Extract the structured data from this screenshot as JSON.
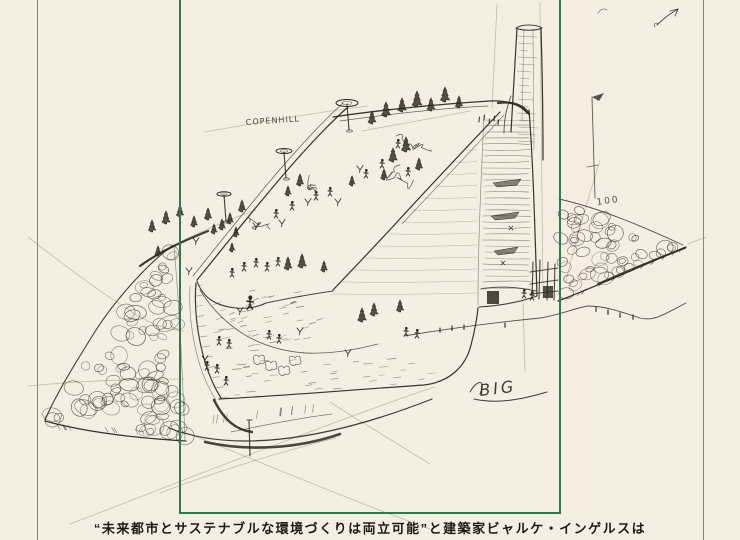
{
  "page": {
    "background": "#f4efe2",
    "ink": "#2b2920",
    "pencil": "#9a917d",
    "frame_color": "#2e7a52",
    "rule_color": "#6f6b5e",
    "caption_color": "#1d1b15"
  },
  "caption": {
    "text": "“未来都市とサステナブルな環境づくりは両立可能”と建築家ビャルケ・インゲルスは"
  },
  "sketch": {
    "building_label": "COPENHILL",
    "elevation_label": "100",
    "signature": "BIG"
  }
}
